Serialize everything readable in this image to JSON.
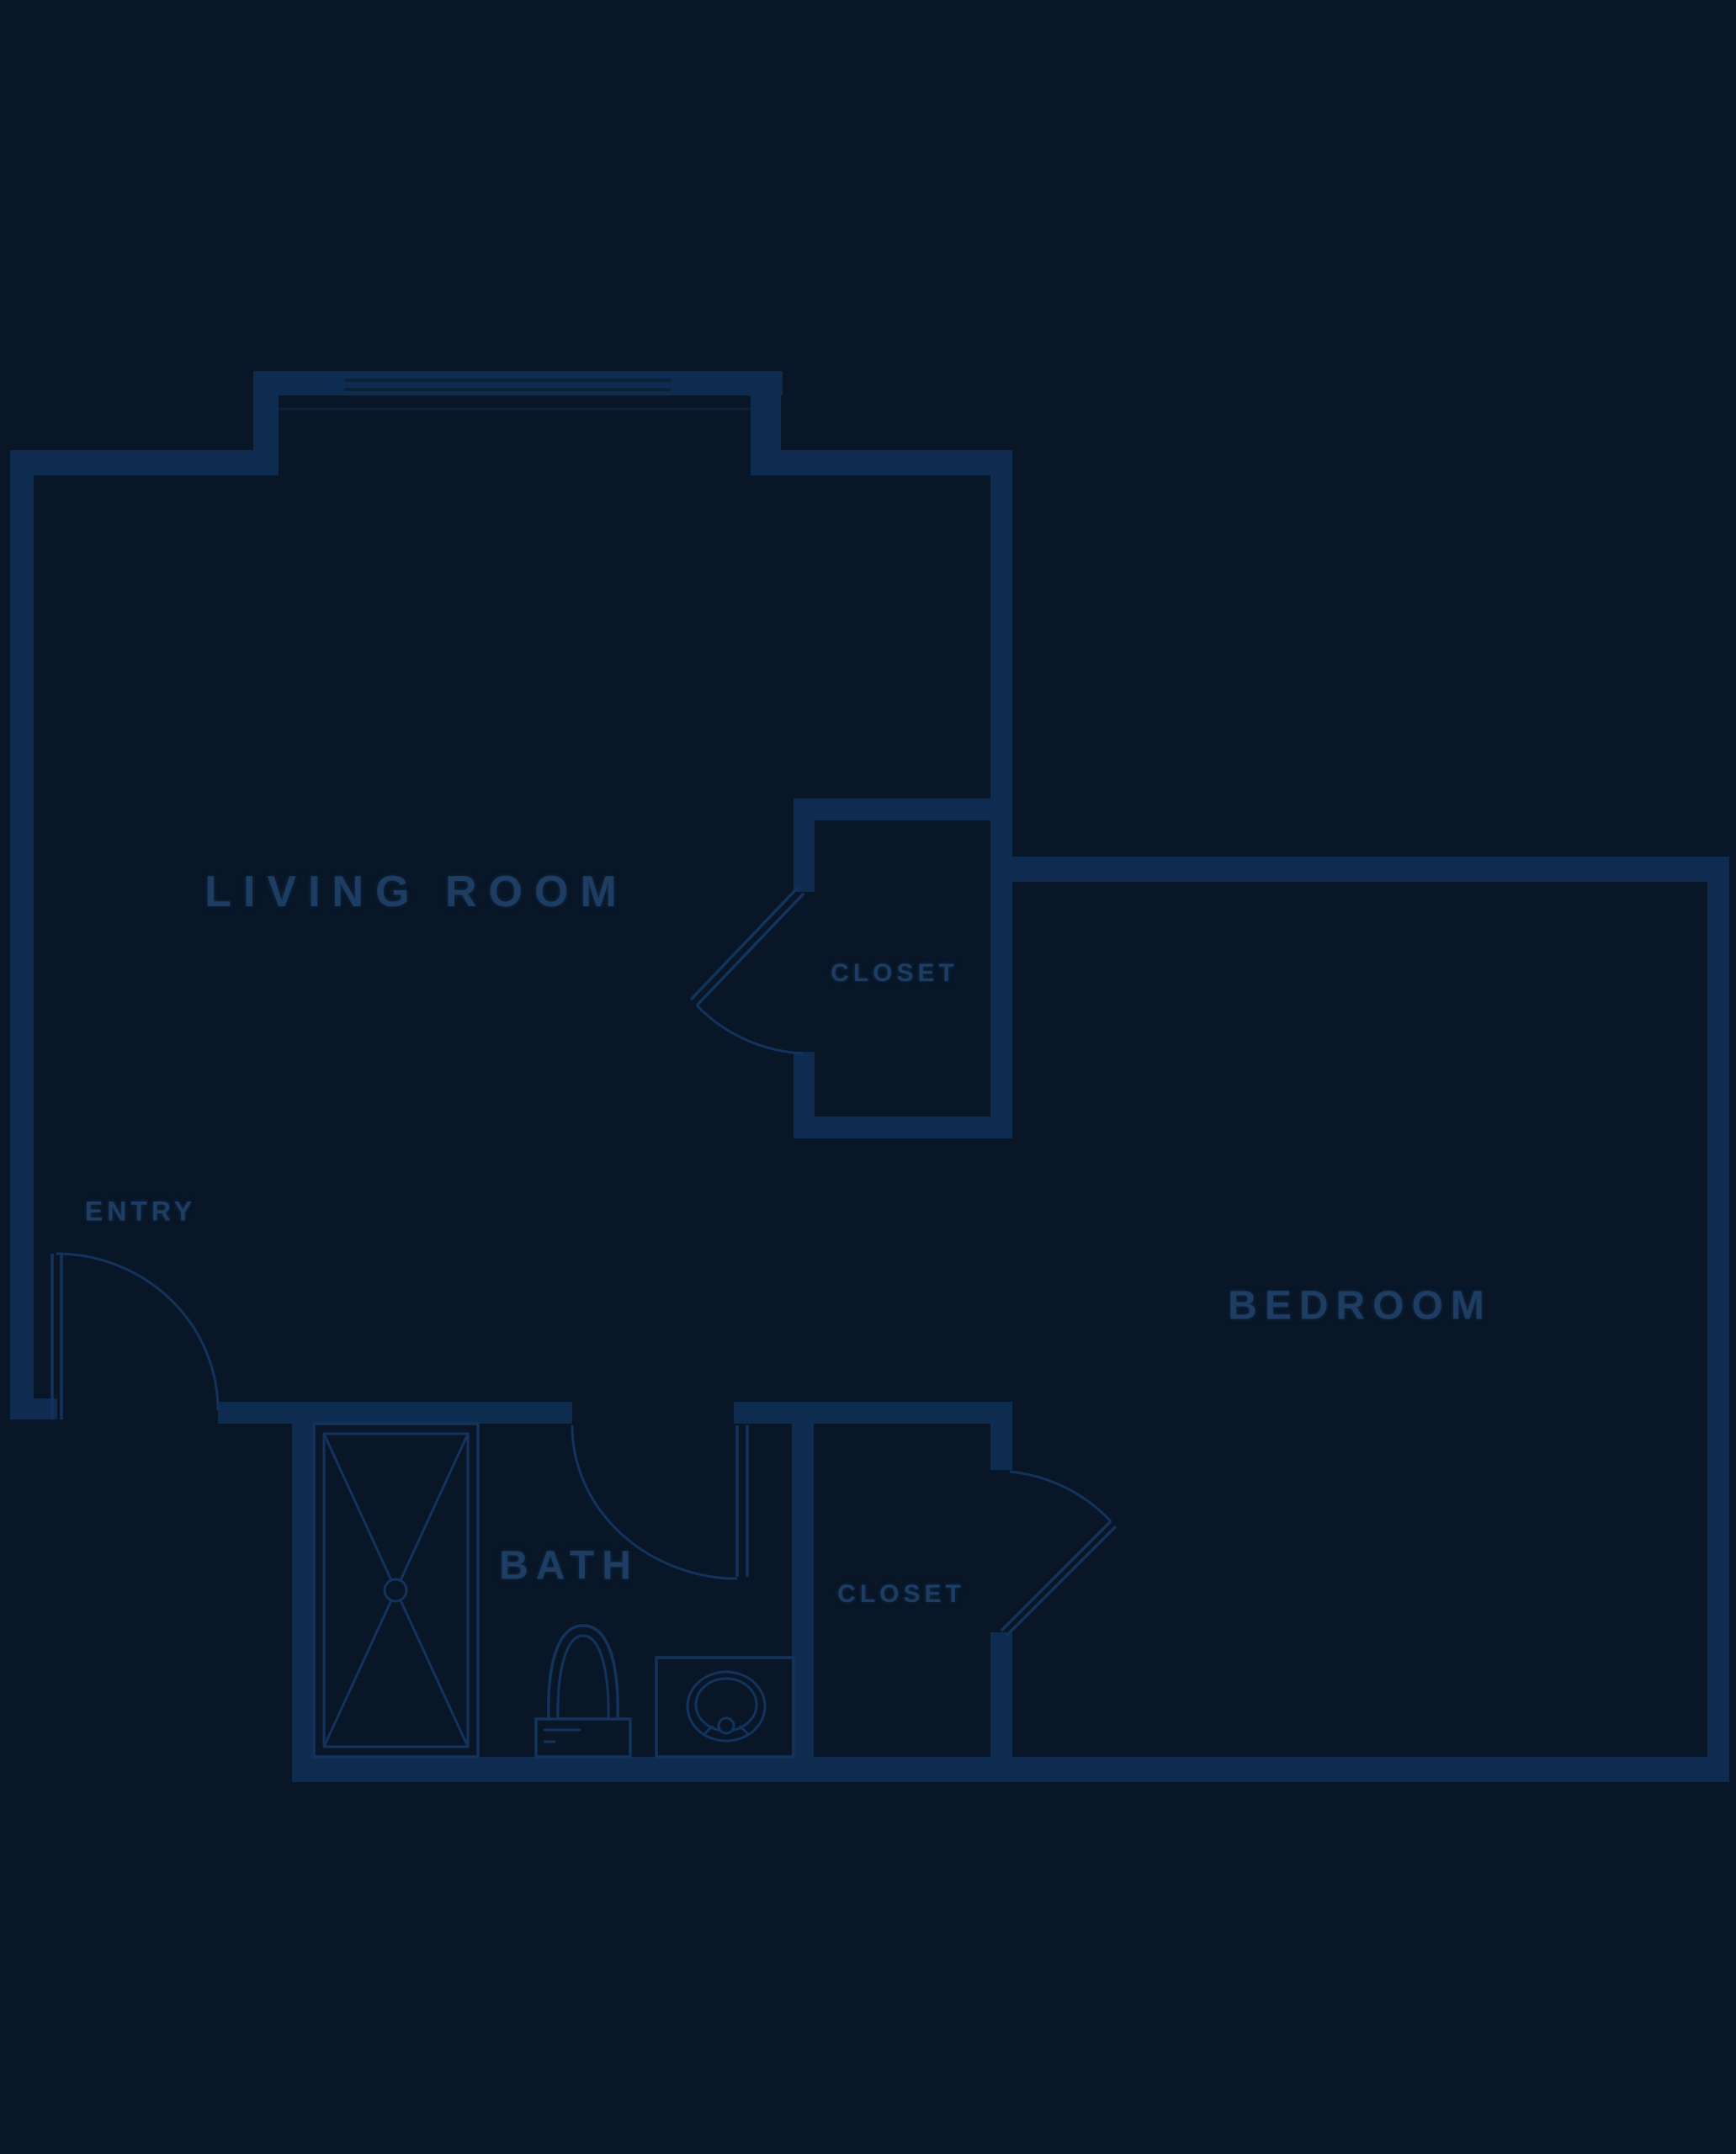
{
  "title": "apartment floor plan",
  "colors": {
    "background": "#081627",
    "wall": "#0e2b50",
    "wall_edge": "#0c2138",
    "line": "#14335c",
    "label": "#1d3d63"
  },
  "labels": {
    "living_room": "LIVING ROOM",
    "bedroom": "BEDROOM",
    "bath": "BATH",
    "living_closet": "CLOSET",
    "bedroom_closet": "CLOSET",
    "entry": "ENTRY"
  }
}
